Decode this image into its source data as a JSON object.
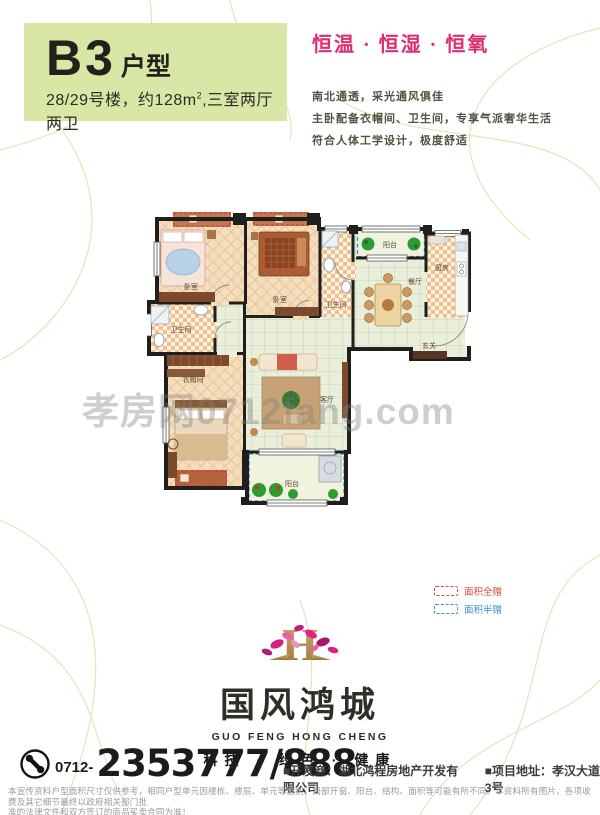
{
  "header": {
    "type_code": "B3",
    "type_suffix": "户型",
    "subtitle_a": "28/29号楼，约128m",
    "subtitle_sup": "2",
    "subtitle_b": ",三室两厅两卫",
    "slogan": "恒温 · 恒湿 · 恒氧",
    "desc_lines": [
      "南北通透，采光通风俱佳",
      "主卧配备衣帽间、卫生间，专享气派奢华生活",
      "符合人体工学设计，极度舒适"
    ]
  },
  "floorplan": {
    "labels": {
      "bedroom1": "卧室",
      "bedroom2": "卧室",
      "bath_top": "卫生间",
      "balcony_top": "阳台",
      "kitchen": "厨房",
      "dining": "餐厅",
      "foyer": "玄关",
      "bath_left": "卫生间",
      "closet": "衣帽间",
      "living": "客厅",
      "balcony_bottom": "阳台"
    },
    "legend": {
      "full_gift": "面积全赠",
      "half_gift": "面积半赠"
    },
    "colors": {
      "gift_full": "#e3392e",
      "gift_half": "#2f8fd0"
    }
  },
  "watermark": "孝房网0712fang.com",
  "logo": {
    "monogram": "H",
    "name_cn": "国风鸿城",
    "name_en": "GUO FENG HONG CHENG",
    "slogan": "科技 · 绿色 · 健康"
  },
  "contact": {
    "area_code": "0712-",
    "phone": "2353777/888",
    "developer": "■开发商：湖北鸿程房地产开发有限公司",
    "address": "■项目地址：孝汉大道3号"
  },
  "disclaimer": [
    "本宣传资料户型面积尺寸仅供参考，相同户型单元因楼栋、楼层、单元等差别，局部开窗、阳台、结构、面积等可能有所不同。本资料所有图片、各项收费及其它细节最终以政府相关部门批",
    "准的法律文件和双方签订的商品买卖合同为准！"
  ],
  "accent_colors": {
    "badge_green": "#d8e7a5",
    "slogan_pink": "#dd2e72"
  }
}
